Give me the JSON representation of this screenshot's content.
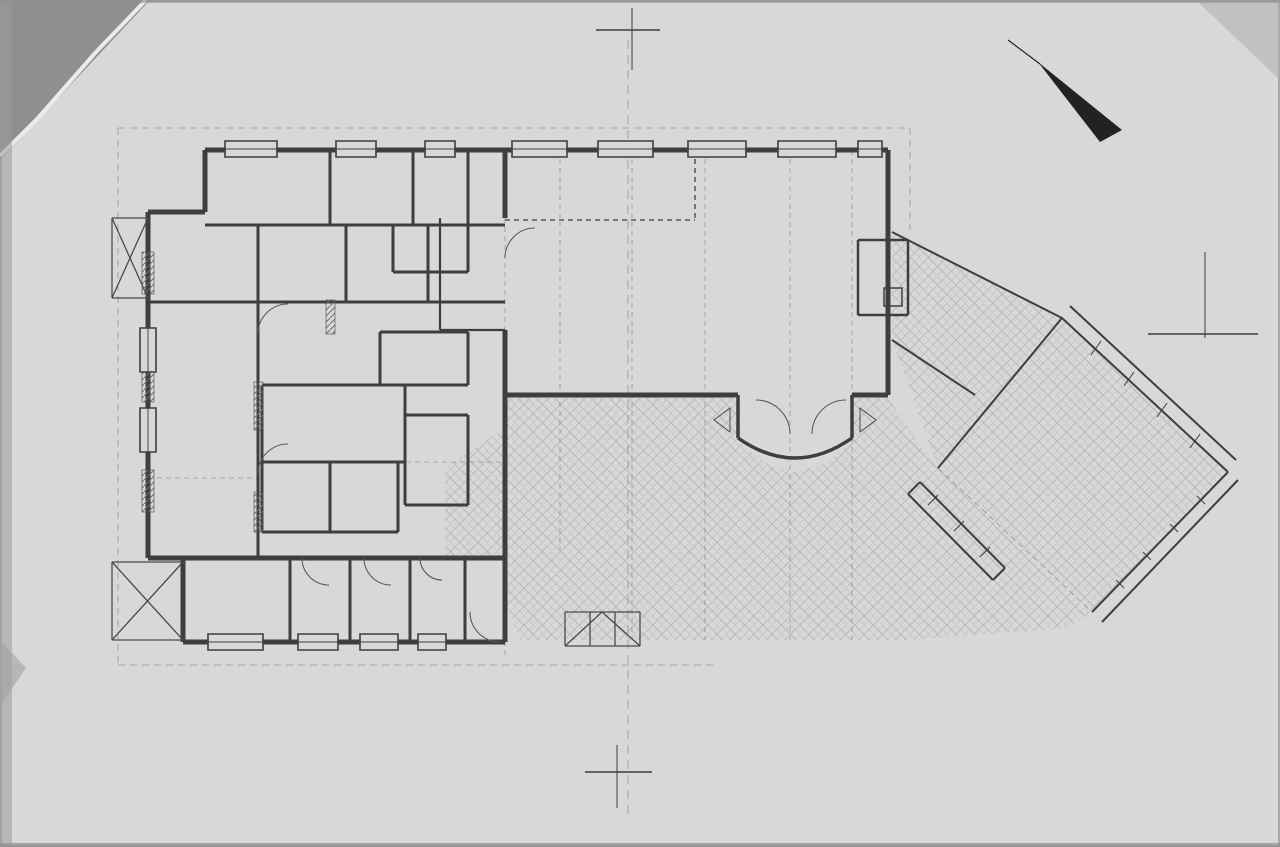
{
  "document": {
    "title": "FÖLDSZINTI ALAPRAJZ M=1:100"
  },
  "north": {
    "label": "ÉSZAK"
  },
  "section_markers": {
    "top": "B",
    "bottom": "B",
    "right": "A"
  },
  "colors": {
    "paper": "#d8d8d6",
    "ink": "#3e3e3e",
    "dim_text": "#474747",
    "paving_stroke": "#b6bab6",
    "furniture": "#989d98",
    "scan_edge": "#8f8f8f"
  },
  "rooms": [
    {
      "name": "szem. öltöző",
      "mat": "lapburkolat",
      "area": "2.86 m²",
      "x": 282,
      "y": 168
    },
    {
      "name": "női wc",
      "mat": "lapburkolat",
      "area": "4.27 m²",
      "x": 398,
      "y": 180
    },
    {
      "name": "előtér",
      "mat": "lapburkolat",
      "area": "3.06 m²",
      "x": 459,
      "y": 190
    },
    {
      "name": "ffi wc",
      "mat": "lapburkolat",
      "area": "2.28 m²",
      "x": 430,
      "y": 238
    },
    {
      "name": "büfé",
      "mat": "lapburkolat",
      "area": "2.77 m²",
      "x": 303,
      "y": 274
    },
    {
      "name": "fehér mosogató",
      "mat": "lapburkolat",
      "area": "2.60 m²",
      "x": 390,
      "y": 268
    },
    {
      "name": "bárpult",
      "mat": "lapburkolat",
      "area": "11.28 m²",
      "x": 477,
      "y": 264
    },
    {
      "name": "szinpad",
      "mat": "lapburkolat",
      "area": "5.56 m²",
      "x": 622,
      "y": 176
    },
    {
      "name": "fogyasztótér",
      "mat": "lapburkolat",
      "area": "64.31 m²",
      "x": 757,
      "y": 290
    },
    {
      "name": "kandalló",
      "x": 882,
      "y": 262,
      "s": 8
    },
    {
      "name": "pincérforgó",
      "mat": "lapburkolat",
      "area": "6.27 m²",
      "x": 437,
      "y": 354
    },
    {
      "name": "közlekedő",
      "mat": "lapburkolat",
      "area": "21.81 m²",
      "x": 213,
      "y": 370
    },
    {
      "name": "főzőkonyha",
      "mat": "lapburkolat",
      "area": "13.22 m²",
      "x": 343,
      "y": 406
    },
    {
      "name": "italraktár",
      "mat": "lapburkolat",
      "area": "5.89 m²",
      "x": 437,
      "y": 448
    },
    {
      "name": "zöldség rakt. és",
      "mat": "lapburkolat",
      "area": "3.08 m²",
      "x": 296,
      "y": 488
    },
    {
      "name": "előkészítők",
      "mat": "lapburkolat",
      "area": "3.96 m²",
      "x": 364,
      "y": 486
    },
    {
      "name": "szélfogó",
      "mat": "lapburkolat",
      "area": "5.06 m²",
      "x": 793,
      "y": 406
    },
    {
      "name": "iroda",
      "mat": "lapburkolat",
      "area": "4.50 m²",
      "note": "pm = 90",
      "x": 233,
      "y": 592
    },
    {
      "name": "pékáru",
      "mat": "lapburkolat",
      "area": "2.77 m²",
      "note": "pm = 90",
      "x": 320,
      "y": 594
    },
    {
      "name": "szárazáru",
      "mat": "lapburkolat",
      "area": "2.53 m²",
      "note": "pm = 90",
      "x": 380,
      "y": 592
    },
    {
      "name": "kazán tak.",
      "mat": "lapburkolat",
      "area": "2.94 m²",
      "x": 437,
      "y": 576,
      "s": 8
    },
    {
      "name": "fedett terasz",
      "mat": "kőburkolat",
      "area": "34.12 m²",
      "x": 1063,
      "y": 452
    },
    {
      "name": "kőburkolattal ellátott terület",
      "x": 700,
      "y": 533,
      "s": 9.5
    }
  ],
  "dim_chains": [
    {
      "o": "h",
      "y": 47,
      "x1": 228,
      "x2": 888,
      "vals": [
        "20.80"
      ]
    },
    {
      "o": "h",
      "y": 64,
      "x1": 212,
      "x2": 898,
      "vals": [
        "30",
        "20.00",
        "30"
      ]
    },
    {
      "o": "h",
      "y": 81,
      "x1": 190,
      "x2": 898,
      "vals": [
        "30",
        "2.50",
        "10",
        "2.50",
        "10",
        "1.10",
        "10",
        "1.20",
        "40",
        "12.30",
        "30"
      ]
    },
    {
      "o": "h",
      "y": 98,
      "x1": 175,
      "x2": 912,
      "vals": [
        "30",
        "1.80",
        "10",
        "1.50",
        "10",
        "2.45",
        "10",
        "1.20",
        "10",
        "12.30",
        "30"
      ]
    },
    {
      "o": "h",
      "y": 113,
      "x1": 190,
      "x2": 905,
      "vals": [
        "8.90",
        "2.10",
        "2.10",
        "2.10",
        "2.10",
        "2.10",
        "1.20"
      ]
    },
    {
      "o": "h",
      "y": 662,
      "x1": 448,
      "x2": 1018,
      "vals": [
        "90",
        "2.10",
        "2.10",
        "2.10",
        "4.20",
        "1.20"
      ]
    },
    {
      "o": "h",
      "y": 688,
      "x1": 130,
      "x2": 940,
      "vals": [
        "2.15",
        "1.85",
        "1.85",
        "2.15",
        "90",
        "1.80",
        "30",
        "1.80",
        "30",
        "1.80",
        "30",
        "1.80",
        "30",
        "1.80",
        "30"
      ]
    },
    {
      "o": "h",
      "y": 713,
      "x1": 118,
      "x2": 940,
      "vals": [
        "30",
        "1.80",
        "10",
        "3.50",
        "10",
        "1.90",
        "30",
        "1.80",
        "30",
        "1.80",
        "30",
        "1.80",
        "30",
        "1.80",
        "30",
        "5.74",
        "14"
      ]
    },
    {
      "o": "h",
      "y": 738,
      "x1": 118,
      "x2": 700,
      "vals": [
        "30",
        "1.80",
        "10",
        "1.70",
        "10",
        "1.70",
        "10",
        "1.90",
        "30",
        "1.88",
        "14",
        "1.96",
        "14",
        "1.96",
        "14"
      ]
    },
    {
      "o": "h",
      "y": 738,
      "x1": 700,
      "x2": 940,
      "vals": [
        "12.30"
      ]
    },
    {
      "o": "h",
      "y": 762,
      "x1": 118,
      "x2": 640,
      "vals": [
        "30",
        "3.00",
        "10",
        "1.40",
        "10",
        "1.65",
        "10",
        "1.05",
        "30"
      ]
    },
    {
      "o": "h",
      "y": 762,
      "x1": 640,
      "x2": 940,
      "vals": [
        "12.30",
        "30"
      ]
    },
    {
      "o": "h",
      "y": 784,
      "x1": 118,
      "x2": 640,
      "vals": [
        "7.40",
        "30"
      ]
    },
    {
      "o": "h",
      "y": 784,
      "x1": 640,
      "x2": 940,
      "vals": [
        "11.60"
      ]
    },
    {
      "o": "h",
      "y": 805,
      "x1": 118,
      "x2": 690,
      "vals": [
        "9.00"
      ]
    },
    {
      "o": "v",
      "x": 58,
      "y1": 168,
      "y2": 640,
      "vals": [
        "14.60"
      ]
    },
    {
      "o": "v",
      "x": 78,
      "y1": 168,
      "y2": 640,
      "vals": [
        "14.00"
      ]
    },
    {
      "o": "v",
      "x": 98,
      "y1": 168,
      "y2": 640,
      "vals": [
        "2.10",
        "4.35",
        "1.80",
        "1.80",
        "1.20",
        "2.50"
      ]
    },
    {
      "o": "v",
      "x": 122,
      "y1": 155,
      "y2": 648,
      "vals": [
        "30",
        "1.30",
        "1.80",
        "10",
        "65",
        "10",
        "1.80",
        "10",
        "1.80",
        "10",
        "1.80",
        "10",
        "1.80",
        "10",
        "1.80",
        "30"
      ]
    },
    {
      "o": "v",
      "x": 548,
      "y1": 398,
      "y2": 648,
      "vals": [
        "3.18",
        "2.80",
        "30"
      ]
    }
  ],
  "labels": [
    {
      "t": "pm = 1.50",
      "x": 516,
      "y": 163,
      "s": 6.5
    },
    {
      "t": "pm = 1.50",
      "x": 610,
      "y": 163,
      "s": 6.5
    },
    {
      "t": "pm = 1.50",
      "x": 702,
      "y": 163,
      "s": 6.5
    },
    {
      "t": "pm = 1.50",
      "x": 790,
      "y": 163,
      "s": 6.5
    },
    {
      "t": "pm = 1.50",
      "x": 866,
      "y": 160,
      "s": 6.5
    },
    {
      "t": "pm = 1.50",
      "x": 145,
      "y": 300,
      "r": 270,
      "s": 6.5
    },
    {
      "t": "pm = 1.50",
      "x": 145,
      "y": 462,
      "r": 270,
      "s": 6.5
    },
    {
      "t": "pm = 0.00",
      "x": 893,
      "y": 220,
      "r": 270,
      "s": 6.5
    },
    {
      "t": "pm = 90",
      "x": 372,
      "y": 318,
      "s": 6.5
    },
    {
      "t": "pm = 90",
      "x": 300,
      "y": 470,
      "s": 6
    },
    {
      "t": "pm = 90",
      "x": 345,
      "y": 470,
      "s": 6
    },
    {
      "t": "pm 1.50",
      "x": 1146,
      "y": 502,
      "r": 45,
      "s": 6.5
    },
    {
      "t": "±0.00",
      "x": 240,
      "y": 508,
      "s": 8
    },
    {
      "t": "±0.00",
      "x": 822,
      "y": 330,
      "s": 8
    },
    {
      "t": "-0.03",
      "x": 140,
      "y": 485,
      "s": 7
    },
    {
      "t": "-0.03",
      "x": 860,
      "y": 490,
      "r": 45,
      "s": 7
    },
    {
      "t": "-0.50",
      "x": 938,
      "y": 604,
      "s": 8
    },
    {
      "t": "1.05",
      "x": 648,
      "y": 337,
      "s": 7.5
    },
    {
      "t": "1.05",
      "x": 700,
      "y": 337,
      "s": 7.5
    },
    {
      "t": "100",
      "x": 745,
      "y": 420,
      "s": 7
    },
    {
      "t": "210",
      "x": 745,
      "y": 431,
      "s": 7
    },
    {
      "t": "100",
      "x": 843,
      "y": 420,
      "s": 7
    },
    {
      "t": "210",
      "x": 843,
      "y": 431,
      "s": 7
    },
    {
      "t": "60",
      "x": 918,
      "y": 226,
      "s": 7
    },
    {
      "t": "300",
      "x": 926,
      "y": 253,
      "s": 7
    },
    {
      "t": "160",
      "x": 920,
      "y": 345,
      "s": 7
    },
    {
      "t": "240",
      "x": 923,
      "y": 357,
      "s": 7
    },
    {
      "t": "3.18",
      "x": 548,
      "y": 452,
      "r": 270,
      "s": 7
    },
    {
      "t": "2.80",
      "x": 548,
      "y": 572,
      "r": 270,
      "s": 7
    },
    {
      "t": "30",
      "x": 547,
      "y": 630,
      "s": 7
    },
    {
      "t": "75",
      "x": 255,
      "y": 296,
      "s": 6.5
    },
    {
      "t": "210",
      "x": 255,
      "y": 306,
      "s": 6.5
    },
    {
      "t": "75",
      "x": 352,
      "y": 296,
      "s": 6.5
    },
    {
      "t": "210",
      "x": 352,
      "y": 306,
      "s": 6.5
    },
    {
      "t": "75",
      "x": 432,
      "y": 296,
      "s": 6.5
    },
    {
      "t": "210",
      "x": 432,
      "y": 306,
      "s": 6.5
    },
    {
      "t": "75",
      "x": 296,
      "y": 545,
      "r": 270,
      "s": 6.5
    },
    {
      "t": "210",
      "x": 306,
      "y": 545,
      "r": 270,
      "s": 6.5
    },
    {
      "t": "75",
      "x": 360,
      "y": 545,
      "r": 270,
      "s": 6.5
    },
    {
      "t": "210",
      "x": 370,
      "y": 545,
      "r": 270,
      "s": 6.5
    },
    {
      "t": "75",
      "x": 420,
      "y": 545,
      "r": 270,
      "s": 6.5
    },
    {
      "t": "210",
      "x": 430,
      "y": 545,
      "r": 270,
      "s": 6.5
    },
    {
      "t": "100",
      "x": 180,
      "y": 300,
      "s": 6.5
    },
    {
      "t": "210",
      "x": 180,
      "y": 311,
      "s": 6.5
    },
    {
      "t": "100",
      "x": 158,
      "y": 540,
      "s": 6.5
    },
    {
      "t": "210",
      "x": 158,
      "y": 551,
      "s": 6.5
    },
    {
      "t": "60",
      "x": 165,
      "y": 330,
      "s": 6.5
    },
    {
      "t": "90",
      "x": 165,
      "y": 341,
      "s": 6.5
    },
    {
      "t": "60",
      "x": 165,
      "y": 452,
      "s": 6.5
    },
    {
      "t": "90",
      "x": 165,
      "y": 463,
      "s": 6.5
    },
    {
      "t": "90",
      "x": 238,
      "y": 406,
      "s": 6.5
    },
    {
      "t": "60",
      "x": 238,
      "y": 417,
      "s": 6.5
    },
    {
      "t": "100",
      "x": 283,
      "y": 370,
      "s": 6.5
    },
    {
      "t": "210",
      "x": 283,
      "y": 381,
      "s": 6.5
    },
    {
      "t": "90",
      "x": 320,
      "y": 312,
      "s": 6.5
    },
    {
      "t": "60",
      "x": 320,
      "y": 323,
      "s": 6.5
    },
    {
      "t": "90",
      "x": 373,
      "y": 333,
      "s": 6.5
    },
    {
      "t": "120",
      "x": 373,
      "y": 344,
      "s": 6.5
    },
    {
      "t": "80",
      "x": 482,
      "y": 483,
      "s": 6.5
    },
    {
      "t": "90",
      "x": 482,
      "y": 494,
      "s": 6.5
    },
    {
      "t": "60",
      "x": 472,
      "y": 592,
      "s": 6.5
    },
    {
      "t": "90",
      "x": 472,
      "y": 604,
      "s": 6.5
    },
    {
      "t": "60",
      "x": 572,
      "y": 133,
      "r": 270,
      "s": 5.5
    },
    {
      "t": "90",
      "x": 580,
      "y": 133,
      "r": 270,
      "s": 5.5
    },
    {
      "t": "60",
      "x": 755,
      "y": 133,
      "r": 270,
      "s": 5.5
    },
    {
      "t": "90",
      "x": 763,
      "y": 133,
      "r": 270,
      "s": 5.5
    },
    {
      "t": "1.60",
      "x": 1190,
      "y": 350,
      "r": 45,
      "s": 7.5
    },
    {
      "t": "1.00",
      "x": 1202,
      "y": 428,
      "r": 45,
      "s": 7.5
    },
    {
      "t": "1.20",
      "x": 1247,
      "y": 518,
      "r": 45,
      "s": 7.5
    },
    {
      "t": "1.50",
      "x": 1194,
      "y": 556,
      "r": 45,
      "s": 7.5
    },
    {
      "t": "4.60",
      "x": 1214,
      "y": 592,
      "r": 45,
      "s": 7.5
    },
    {
      "t": "1.44",
      "x": 1128,
      "y": 648,
      "r": 45,
      "s": 7
    },
    {
      "t": "60",
      "x": 1150,
      "y": 663,
      "r": 45,
      "s": 7
    },
    {
      "t": "1.20",
      "x": 1122,
      "y": 690,
      "r": 45,
      "s": 7
    },
    {
      "t": "2.30",
      "x": 945,
      "y": 170,
      "r": 45,
      "s": 7.5
    },
    {
      "t": "B",
      "x": 616,
      "y": 26,
      "r": 270,
      "s": 15,
      "b": true
    },
    {
      "t": "B",
      "x": 600,
      "y": 793,
      "r": 270,
      "s": 15,
      "b": true
    },
    {
      "t": "A",
      "x": 1222,
      "y": 302,
      "s": 18,
      "b": true
    },
    {
      "t": "ÉSZAK",
      "x": 1133,
      "y": 153,
      "r": 47,
      "s": 9
    }
  ],
  "furniture_regions": [
    {
      "x": 560,
      "y": 172,
      "w": 300,
      "h": 50,
      "step": 74,
      "size": 16
    },
    {
      "x": 545,
      "y": 250,
      "w": 330,
      "h": 140,
      "step": 70,
      "size": 24
    },
    {
      "x": 520,
      "y": 425,
      "w": 210,
      "h": 40,
      "step": 68,
      "size": 20
    },
    {
      "x": 960,
      "y": 350,
      "w": 230,
      "h": 230,
      "step": 68,
      "size": 24,
      "clip": "terrace"
    }
  ]
}
